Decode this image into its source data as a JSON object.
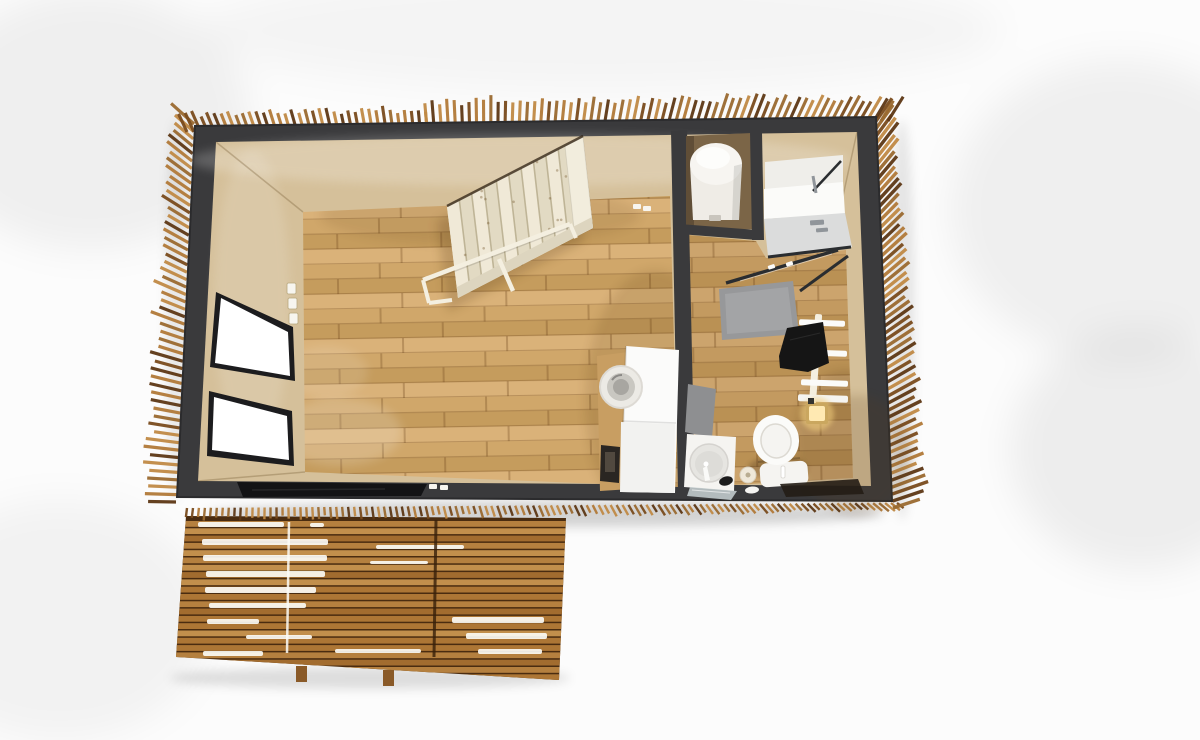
{
  "scene": {
    "description": "Top-down 3D rendering of a tiny house floor plan with wood slat cladding and front deck",
    "rooms": [
      "main-room",
      "bathroom",
      "boiler-closet",
      "shower",
      "deck"
    ],
    "elements": [
      "wood-slat-cladding",
      "dark-perimeter-wall",
      "wood-plank-floor",
      "white-staircase",
      "stair-handrail",
      "window",
      "window",
      "light-switches",
      "black-glass-door",
      "washing-machine-column",
      "wood-cabinet",
      "framed-picture",
      "boiler-tank",
      "shower-enclosure",
      "shower-glass-door",
      "shower-tray-mat",
      "bath-mat",
      "towel-ladder",
      "black-towel",
      "wall-sconce",
      "toilet",
      "toilet-paper-roll",
      "sink-unit",
      "soap-dish",
      "glass-shelf",
      "dark-rug",
      "wood-deck",
      "deck-feet"
    ]
  },
  "colors": {
    "background": "#fcfcfc",
    "wall_dark": "#3a3a3c",
    "wall_edge": "#2b2b2d",
    "interior_base": "#d5c09a",
    "interior_closet": "#7b6547",
    "corner_seam": "rgba(120,95,55,0.35)",
    "floor_a": "#d0a76a",
    "floor_b": "#c59c5d",
    "floor_c": "#dab279",
    "floor_seam": "rgba(105,65,25,0.30)",
    "window_frame": "#1c1c1e",
    "window_pane": "#ffffff",
    "door_glass": "#131315",
    "switch": "#f7f5ef",
    "stairs_body": "#e9e2cd",
    "stairs_stringer": "#f2eddd",
    "stairs_stringer2": "#ddd5bf",
    "stairs_line": "#b5aa8a",
    "stairs_rail": "#f4efe0",
    "fix_white": "#f5f4f1",
    "fix_white_bright": "#fbfbf9",
    "fix_gray_floor": "#dbdcdc",
    "fix_gray_upper": "#efeeea",
    "mat_gray": "#97989a",
    "mat_gray2": "#8e8f91",
    "chrome": "#90959a",
    "glass_line": "#2a2d30",
    "basin": "#e6e5e1",
    "basin_inner": "#dddcd8",
    "towel": "#151515",
    "rug_dark": "#241d15",
    "sconce_glow": "#f2cf7e",
    "sconce_body": "#caa75f",
    "sconce_bright": "#ffe9b2",
    "paper_roll": "#efe8d9",
    "boiler_body": "#efece6",
    "boiler_top": "#f7f5f1",
    "deck_base": "#4a2c10",
    "deck_light_gap": "#fdfdf8",
    "deck_seam_dark": "#38200a",
    "furn_wood": "#c89e62",
    "furn_white": "#fbfbfa",
    "furn_lower": "#f2f2f0",
    "drum_ring": "#eceae5",
    "drum_mid": "#c9c7c1",
    "drum_core": "#a8a6a1",
    "picture_frame": "#2a2622"
  },
  "gen": {
    "slat_palette": [
      "#c08a45",
      "#9a6a30",
      "#7a4b1d",
      "#b27a38",
      "#5d3715",
      "#a8archive"
    ],
    "bands": [
      {
        "id": "top-left-seg",
        "x0": 187,
        "y0": 132,
        "x1": 427,
        "y1": 129,
        "count": 36,
        "w": 3.1,
        "len": [
          16,
          24
        ],
        "a0": -115,
        "a1": -95,
        "seed": 11
      },
      {
        "id": "top-right-seg",
        "x0": 427,
        "y0": 128,
        "x1": 888,
        "y1": 121,
        "count": 66,
        "w": 3.1,
        "len": [
          22,
          32
        ],
        "a0": -95,
        "a1": -58,
        "seed": 12
      },
      {
        "id": "left",
        "x0": 194,
        "y0": 124,
        "x1": 176,
        "y1": 502,
        "count": 52,
        "w": 3.2,
        "len": [
          24,
          36
        ],
        "a0": 222,
        "a1": 181,
        "seed": 13
      },
      {
        "id": "right",
        "x0": 874,
        "y0": 124,
        "x1": 893,
        "y1": 508,
        "count": 56,
        "w": 3.4,
        "len": [
          26,
          38
        ],
        "a0": -55,
        "a1": -18,
        "seed": 14
      },
      {
        "id": "bottom",
        "x0": 187,
        "y0": 508,
        "x1": 897,
        "y1": 503,
        "count": 120,
        "w": 2.4,
        "len": [
          8,
          13
        ],
        "a0": 97,
        "a1": 38,
        "seed": 15
      }
    ],
    "deck": {
      "x0": 170,
      "x1": 570,
      "y0": 521,
      "y1": 679,
      "row_h": 5.8,
      "gap": 1.5,
      "seed": 7,
      "palette": [
        "#b5803f",
        "#a26c2f",
        "#c28f4c",
        "#ad7635"
      ],
      "streaks": [
        [
          198,
          522,
          86,
          5
        ],
        [
          310,
          523,
          14,
          4
        ],
        [
          202,
          539,
          126,
          6
        ],
        [
          203,
          555,
          124,
          6
        ],
        [
          206,
          571,
          119,
          6
        ],
        [
          205,
          587,
          111,
          6
        ],
        [
          209,
          603,
          97,
          5
        ],
        [
          207,
          619,
          52,
          5
        ],
        [
          376,
          545,
          88,
          4
        ],
        [
          370,
          561,
          58,
          3
        ],
        [
          452,
          617,
          92,
          6
        ],
        [
          466,
          633,
          81,
          6
        ],
        [
          478,
          649,
          64,
          5
        ],
        [
          335,
          649,
          86,
          4
        ],
        [
          246,
          635,
          66,
          4
        ],
        [
          203,
          651,
          60,
          5
        ]
      ],
      "feet": [
        [
          296,
          666,
          11,
          16
        ],
        [
          383,
          670,
          11,
          16
        ]
      ]
    },
    "stairs": {
      "L": [
        447,
        207
      ],
      "T": [
        583,
        137
      ],
      "R": [
        593,
        228
      ],
      "B": [
        458,
        298
      ],
      "treads": 11,
      "speckles": 18,
      "seed": 5,
      "tread_colors": [
        "#f0e9d7",
        "#e2dac3"
      ]
    }
  }
}
